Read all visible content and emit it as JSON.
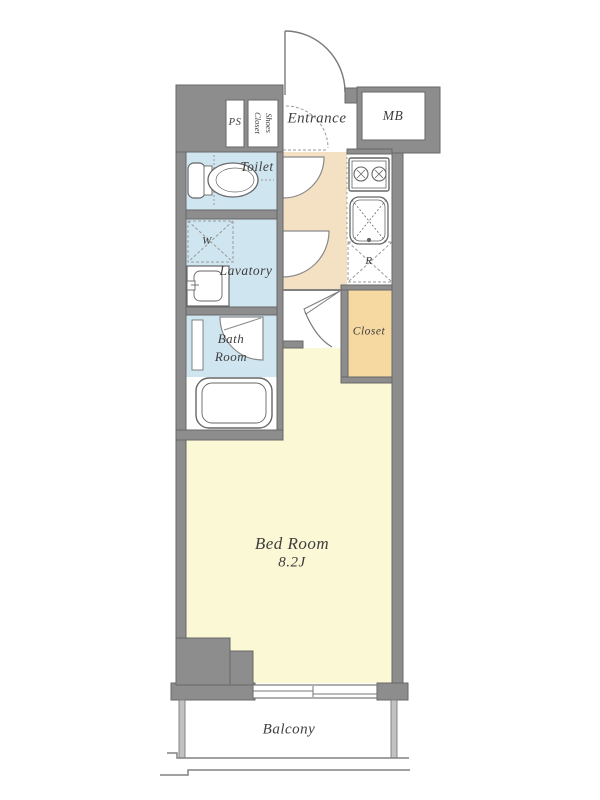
{
  "plan": {
    "labels": {
      "ps": "PS",
      "shoes_line1": "Shoes",
      "shoes_line2": "Closet",
      "entrance": "Entrance",
      "mb": "MB",
      "toilet": "Toilet",
      "washer": "W",
      "lavatory": "Lavatory",
      "bath_line1": "Bath",
      "bath_line2": "Room",
      "closet": "Closet",
      "fridge": "R",
      "bedroom_name": "Bed Room",
      "bedroom_area": "8.2J",
      "balcony": "Balcony"
    },
    "colors": {
      "wall": "#8d8d8d",
      "wall-edge": "#686868",
      "wet-room": "#cfe5f0",
      "hall": "#f4e0c3",
      "closet": "#f5d9a1",
      "bedroom": "#fbf8d6",
      "line": "#828282",
      "railing": "#c2c2c2",
      "fixture": "#666666",
      "dash": "#9a9a9a",
      "text": "#3e3e3e",
      "floor": "#ffffff"
    }
  }
}
